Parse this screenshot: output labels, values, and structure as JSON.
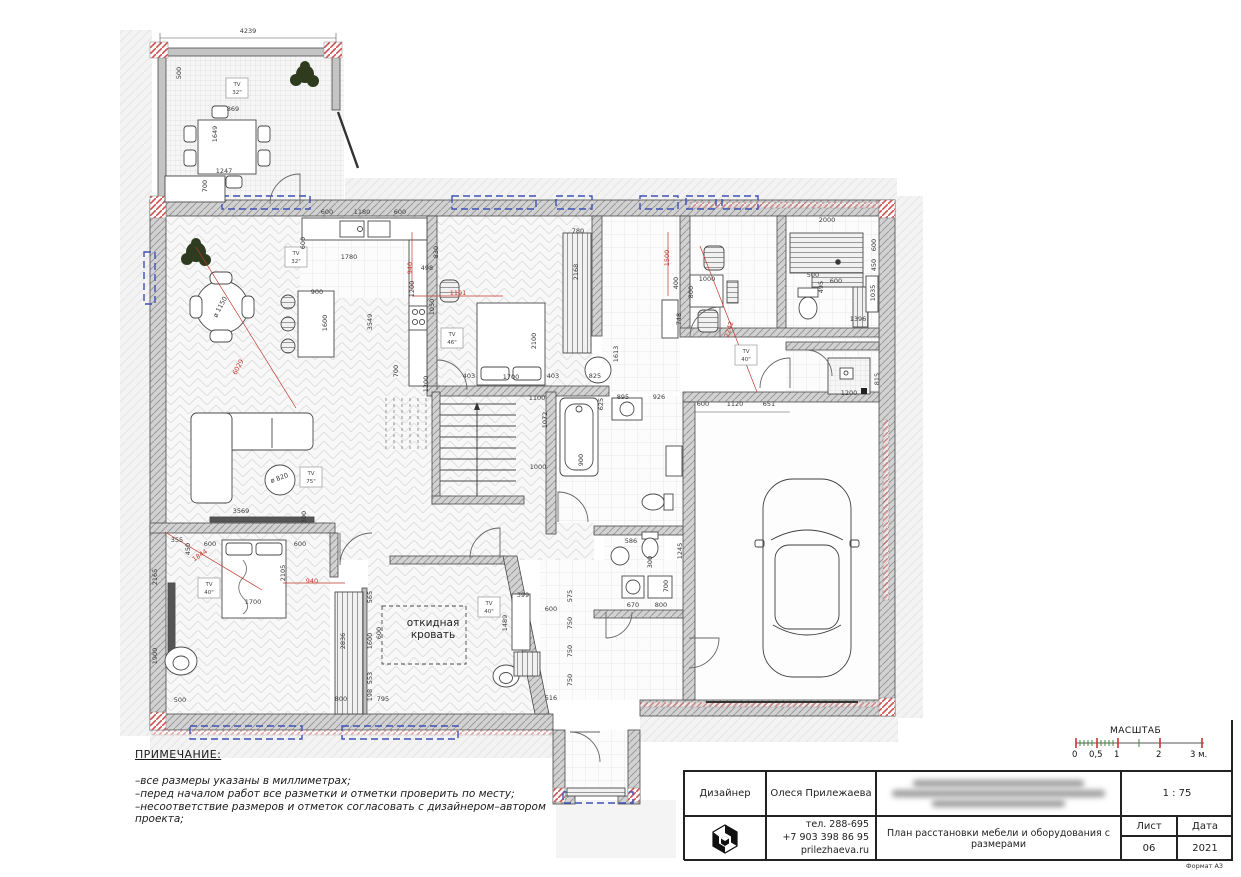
{
  "colors": {
    "accent_red": "#c0392b",
    "dim_ink": "#3a3a3a",
    "window_blue": "#3f51b5",
    "wall_gray": "#d2d2d2"
  },
  "notes": {
    "title": "ПРИМЕЧАНИЕ:",
    "lines": [
      "–все размеры указаны в миллиметрах;",
      "–перед началом работ все разметки и отметки проверить по месту;",
      "–несоответствие размеров и отметок согласовать с дизайнером–автором проекта;"
    ]
  },
  "scalebar": {
    "title": "МАСШТАБ",
    "ticks": [
      {
        "label": "0",
        "x": 0
      },
      {
        "label": "0,5",
        "x": 17
      },
      {
        "label": "1",
        "x": 42
      },
      {
        "label": "2",
        "x": 84
      },
      {
        "label": "3 м.",
        "x": 118
      }
    ]
  },
  "titleblock": {
    "designer_label": "Дизайнер",
    "designer_name": "Олеся Прилежаева",
    "phone1": "тел. 288-695",
    "phone2": "+7 903 398 86 95",
    "website": "prilezhaeva.ru",
    "drawing_title": "План расстановки мебели и оборудования с размерами",
    "scale_value": "1 : 75",
    "sheet_label": "Лист",
    "sheet_value": "06",
    "date_label": "Дата",
    "date_value": "2021",
    "format_label": "Формат А3"
  },
  "plan": {
    "room_labels": {
      "fold_bed": "откидная кровать"
    },
    "tv_labels": [
      {
        "s": "32\"",
        "x": 237,
        "y": 88
      },
      {
        "s": "32\"",
        "x": 296,
        "y": 257
      },
      {
        "s": "46\"",
        "x": 452,
        "y": 338
      },
      {
        "s": "40\"",
        "x": 746,
        "y": 355
      },
      {
        "s": "40\"",
        "x": 209,
        "y": 588
      },
      {
        "s": "40\"",
        "x": 489,
        "y": 607
      },
      {
        "s": "75\"",
        "x": 311,
        "y": 477
      }
    ],
    "dims": [
      {
        "t": "4239",
        "x": 248,
        "y": 33
      },
      {
        "t": "500",
        "x": 181,
        "y": 73,
        "r": -90
      },
      {
        "t": "869",
        "x": 233,
        "y": 111
      },
      {
        "t": "1649",
        "x": 217,
        "y": 134,
        "r": -90
      },
      {
        "t": "1247",
        "x": 224,
        "y": 173
      },
      {
        "t": "700",
        "x": 207,
        "y": 186,
        "r": -90
      },
      {
        "t": "600",
        "x": 327,
        "y": 214
      },
      {
        "t": "1180",
        "x": 362,
        "y": 214
      },
      {
        "t": "600",
        "x": 400,
        "y": 214
      },
      {
        "t": "600",
        "x": 305,
        "y": 243,
        "r": -90
      },
      {
        "t": "1780",
        "x": 349,
        "y": 259
      },
      {
        "t": "940",
        "x": 412,
        "y": 268,
        "r": -90,
        "c": "r"
      },
      {
        "t": "900",
        "x": 317,
        "y": 294
      },
      {
        "t": "1600",
        "x": 327,
        "y": 323,
        "r": -90
      },
      {
        "t": "1191",
        "x": 458,
        "y": 295,
        "c": "r"
      },
      {
        "t": "ø 1150",
        "x": 222,
        "y": 308,
        "r": -62
      },
      {
        "t": "6029",
        "x": 240,
        "y": 368,
        "r": -62,
        "c": "r"
      },
      {
        "t": "3549",
        "x": 372,
        "y": 322,
        "r": -90
      },
      {
        "t": "1200",
        "x": 414,
        "y": 289,
        "r": -90
      },
      {
        "t": "498",
        "x": 427,
        "y": 270
      },
      {
        "t": "1050",
        "x": 434,
        "y": 307,
        "r": -90
      },
      {
        "t": "1200",
        "x": 428,
        "y": 384,
        "r": -90
      },
      {
        "t": "700",
        "x": 398,
        "y": 371,
        "r": -90
      },
      {
        "t": "830",
        "x": 438,
        "y": 252,
        "r": -90
      },
      {
        "t": "780",
        "x": 578,
        "y": 233
      },
      {
        "t": "2168",
        "x": 578,
        "y": 272,
        "r": -90
      },
      {
        "t": "2100",
        "x": 536,
        "y": 341,
        "r": -90
      },
      {
        "t": "403",
        "x": 469,
        "y": 378
      },
      {
        "t": "1700",
        "x": 511,
        "y": 379
      },
      {
        "t": "403",
        "x": 553,
        "y": 378
      },
      {
        "t": "1100",
        "x": 537,
        "y": 400
      },
      {
        "t": "1072",
        "x": 547,
        "y": 420,
        "r": -90
      },
      {
        "t": "1000",
        "x": 538,
        "y": 469
      },
      {
        "t": "900",
        "x": 583,
        "y": 460,
        "r": -90
      },
      {
        "t": "625",
        "x": 603,
        "y": 404,
        "r": -90
      },
      {
        "t": "895",
        "x": 623,
        "y": 399
      },
      {
        "t": "926",
        "x": 659,
        "y": 399
      },
      {
        "t": "1613",
        "x": 618,
        "y": 354,
        "r": -90
      },
      {
        "t": "825",
        "x": 595,
        "y": 378
      },
      {
        "t": "1500",
        "x": 669,
        "y": 258,
        "r": -90,
        "c": "r"
      },
      {
        "t": "400",
        "x": 678,
        "y": 283,
        "r": -90
      },
      {
        "t": "748",
        "x": 681,
        "y": 319,
        "r": -90
      },
      {
        "t": "1000",
        "x": 707,
        "y": 281
      },
      {
        "t": "800",
        "x": 693,
        "y": 292,
        "r": -90
      },
      {
        "t": "2242",
        "x": 731,
        "y": 330,
        "r": -72,
        "c": "r"
      },
      {
        "t": "2000",
        "x": 827,
        "y": 222
      },
      {
        "t": "600",
        "x": 876,
        "y": 245,
        "r": -90
      },
      {
        "t": "450",
        "x": 876,
        "y": 265,
        "r": -90
      },
      {
        "t": "500",
        "x": 813,
        "y": 277
      },
      {
        "t": "495",
        "x": 823,
        "y": 287,
        "r": -90
      },
      {
        "t": "600",
        "x": 836,
        "y": 283
      },
      {
        "t": "1035",
        "x": 875,
        "y": 293,
        "r": -90
      },
      {
        "t": "1396",
        "x": 858,
        "y": 321
      },
      {
        "t": "1200",
        "x": 849,
        "y": 395
      },
      {
        "t": "815",
        "x": 879,
        "y": 379,
        "r": -90
      },
      {
        "t": "600",
        "x": 703,
        "y": 406
      },
      {
        "t": "1120",
        "x": 735,
        "y": 406
      },
      {
        "t": "651",
        "x": 769,
        "y": 406
      },
      {
        "t": "586",
        "x": 631,
        "y": 543
      },
      {
        "t": "300",
        "x": 652,
        "y": 562,
        "r": -90
      },
      {
        "t": "700",
        "x": 668,
        "y": 586,
        "r": -90
      },
      {
        "t": "670",
        "x": 633,
        "y": 607
      },
      {
        "t": "800",
        "x": 661,
        "y": 607
      },
      {
        "t": "1245",
        "x": 682,
        "y": 551,
        "r": -90
      },
      {
        "t": "3569",
        "x": 241,
        "y": 513
      },
      {
        "t": "300",
        "x": 306,
        "y": 517,
        "r": -90
      },
      {
        "t": "355",
        "x": 177,
        "y": 542
      },
      {
        "t": "450",
        "x": 190,
        "y": 549,
        "r": -90
      },
      {
        "t": "600",
        "x": 210,
        "y": 546
      },
      {
        "t": "600",
        "x": 300,
        "y": 546
      },
      {
        "t": "1844",
        "x": 201,
        "y": 557,
        "r": -34,
        "c": "r"
      },
      {
        "t": "2105",
        "x": 285,
        "y": 573,
        "r": -90
      },
      {
        "t": "1700",
        "x": 253,
        "y": 604
      },
      {
        "t": "940",
        "x": 312,
        "y": 583,
        "c": "r"
      },
      {
        "t": "2165",
        "x": 157,
        "y": 577,
        "r": -90
      },
      {
        "t": "1900",
        "x": 157,
        "y": 656,
        "r": -90
      },
      {
        "t": "500",
        "x": 180,
        "y": 702
      },
      {
        "t": "2836",
        "x": 345,
        "y": 641,
        "r": -90
      },
      {
        "t": "800",
        "x": 341,
        "y": 701
      },
      {
        "t": "795",
        "x": 383,
        "y": 701
      },
      {
        "t": "565",
        "x": 372,
        "y": 597,
        "r": -90
      },
      {
        "t": "1600",
        "x": 372,
        "y": 641,
        "r": -90
      },
      {
        "t": "553",
        "x": 372,
        "y": 678,
        "r": -90
      },
      {
        "t": "198",
        "x": 372,
        "y": 695,
        "r": -90
      },
      {
        "t": "600",
        "x": 381,
        "y": 633,
        "r": -90
      },
      {
        "t": "399",
        "x": 523,
        "y": 597
      },
      {
        "t": "1489",
        "x": 507,
        "y": 623,
        "r": -90
      },
      {
        "t": "600",
        "x": 551,
        "y": 611
      },
      {
        "t": "575",
        "x": 572,
        "y": 596,
        "r": -90
      },
      {
        "t": "750",
        "x": 572,
        "y": 623,
        "r": -90
      },
      {
        "t": "750",
        "x": 572,
        "y": 651,
        "r": -90
      },
      {
        "t": "750",
        "x": 572,
        "y": 680,
        "r": -90
      },
      {
        "t": "516",
        "x": 551,
        "y": 700
      },
      {
        "t": "ø 820",
        "x": 280,
        "y": 480,
        "r": -20
      }
    ]
  }
}
